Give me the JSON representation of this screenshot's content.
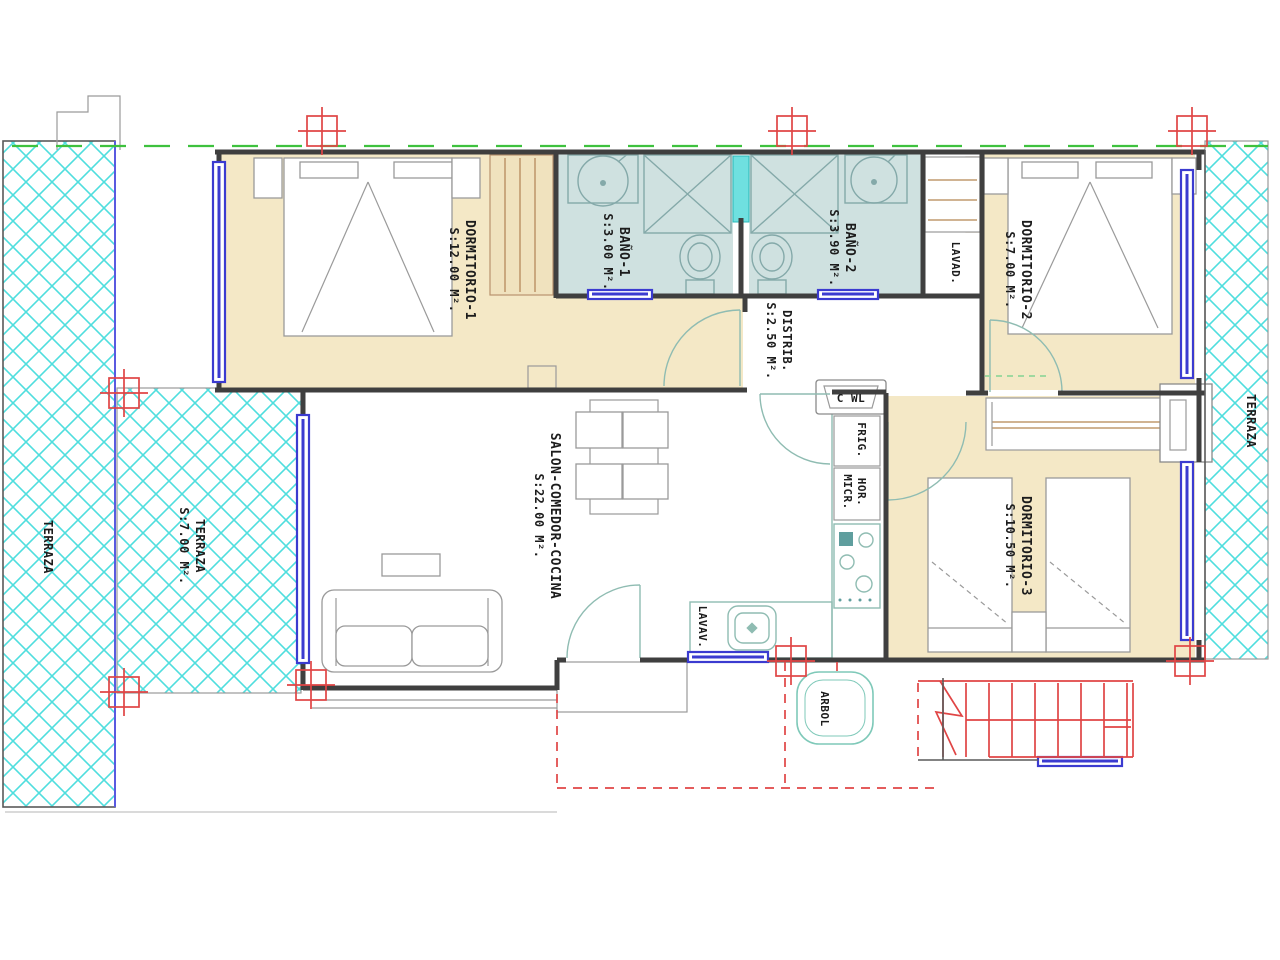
{
  "plan": {
    "rooms": {
      "dormitorio1": {
        "name": "DORMITORIO-1",
        "area": "S:12.00 M²."
      },
      "bano1": {
        "name": "BAÑO-1",
        "area": "S:3.00 M²."
      },
      "bano2": {
        "name": "BAÑO-2",
        "area": "S:3.90 M²."
      },
      "dormitorio2": {
        "name": "DORMITORIO-2",
        "area": "S:7.00 M²."
      },
      "distribuidor": {
        "name": "DISTRIB.",
        "area": "S:2.50 M²."
      },
      "salon": {
        "name": "SALON-COMEDOR-COCINA",
        "area": "S:22.00 M²."
      },
      "dormitorio3": {
        "name": "DORMITORIO-3",
        "area": "S:10.50 M²."
      },
      "terraza_left": {
        "name": "TERRAZA"
      },
      "terraza_front": {
        "name": "TERRAZA",
        "area": "S:7.00 M²."
      },
      "terraza_right": {
        "name": "TERRAZA"
      }
    },
    "fixtures": {
      "lavadero": "LAVAD.",
      "lavavajillas": "LAVAV.",
      "frigorifico": "FRIG.",
      "horno": "HOR.",
      "microondas": "MICR.",
      "cwl": "C WL",
      "arbol": "ARBOL"
    },
    "colors": {
      "bedroom_fill": "#f4e8c6",
      "bathroom_fill": "#cfe1e0",
      "terrace_hatch": "#4fdede",
      "window_blue": "#3b3bd0",
      "structure_red": "#e04545",
      "boundary_green": "#3ec13e",
      "wall_dark": "#3f3f3f",
      "wood_tan": "#c09a6e",
      "fixture_teal": "#8fbcb2"
    }
  }
}
